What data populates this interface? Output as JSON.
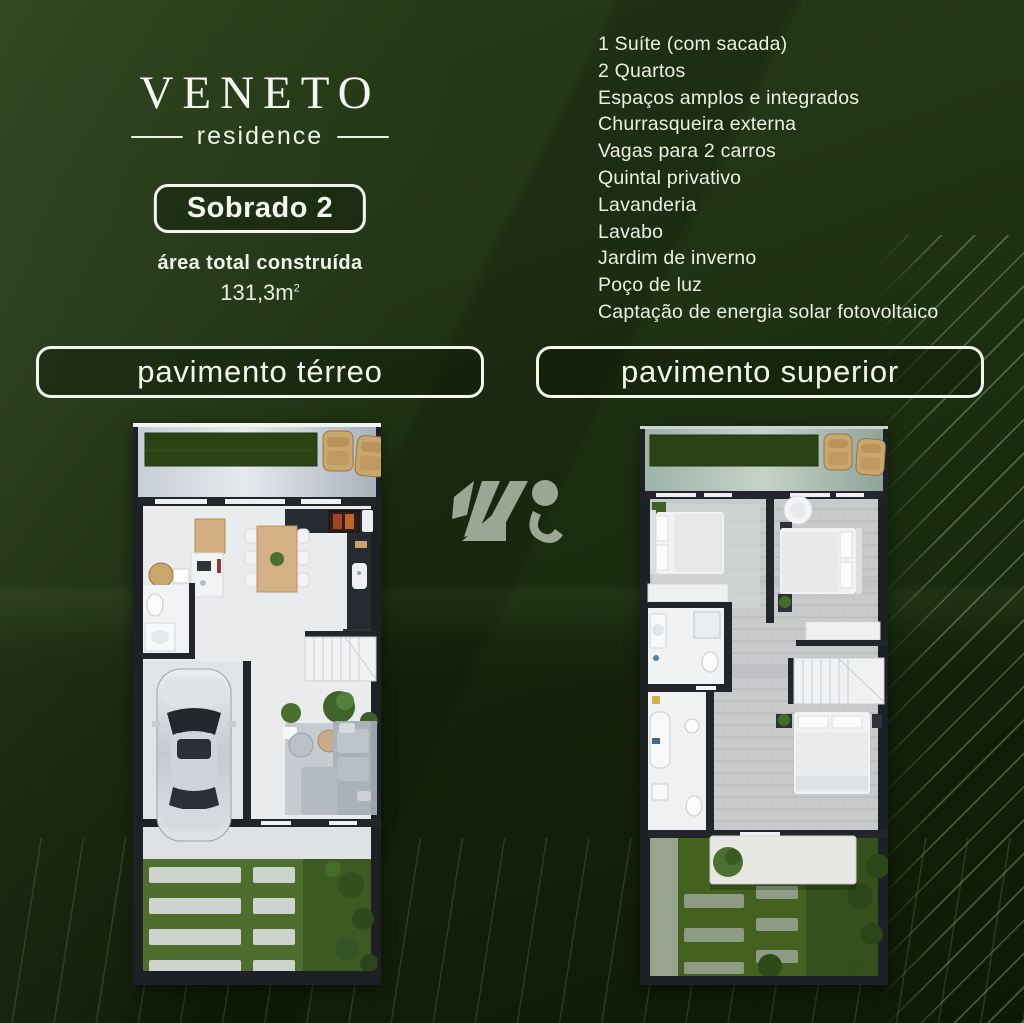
{
  "brand": {
    "name": "VENETO",
    "subtitle": "residence"
  },
  "unit": {
    "badge": "Sobrado 2",
    "area_label": "área total construída",
    "area_value": "131,3m",
    "area_exponent": "2"
  },
  "features": {
    "items": [
      "1 Suíte (com sacada)",
      "2 Quartos",
      "Espaços amplos e integrados",
      "Churrasqueira externa",
      "Vagas para 2 carros",
      "Quintal privativo",
      "Lavanderia",
      "Lavabo",
      "Jardim de inverno",
      "Poço de luz",
      "Captação de energia solar fotovoltaico"
    ]
  },
  "plans": {
    "ground_label": "pavimento térreo",
    "upper_label": "pavimento superior"
  },
  "colors": {
    "background_green": "#1e3111",
    "panel_green": "#16280c",
    "text_light": "#f2f6ec",
    "stripe_green": "#8fa682",
    "wood": "#d3b183",
    "chair_tan": "#c9a66c",
    "grass_dark": "#2c4316",
    "lawn_green": "#4e6e2d",
    "floor_light": "#e9ebed",
    "wall_dark": "#22262b"
  }
}
